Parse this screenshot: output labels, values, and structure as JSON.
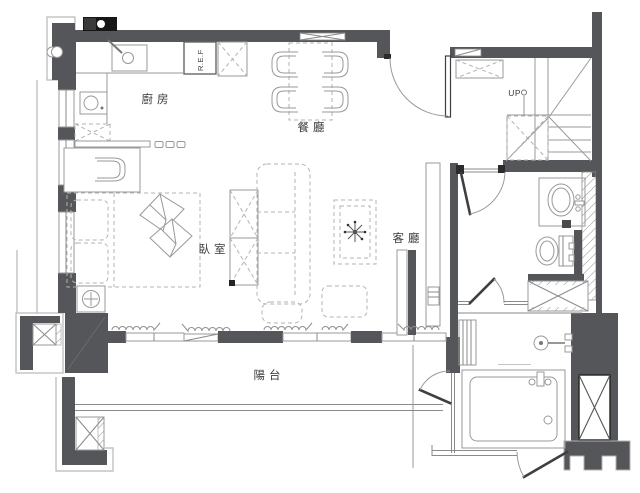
{
  "plan": {
    "type": "apartment-floor-plan",
    "rooms": {
      "kitchen": {
        "label": "廚房"
      },
      "dining": {
        "label": "餐廳"
      },
      "bedroom": {
        "label": "臥室"
      },
      "living": {
        "label": "客廳"
      },
      "balcony": {
        "label": "陽台"
      }
    },
    "annotations": {
      "stairs_up": "UP",
      "refrigerator": "R.E.F"
    },
    "colors": {
      "wall": "#55565a",
      "furniture_line": "#999999",
      "dashed_furniture": "#b3b3b3",
      "hatch": "#9a9a9a",
      "black_fixture": "#161616",
      "label_text": "#3a3a3a",
      "background": "#ffffff"
    }
  }
}
